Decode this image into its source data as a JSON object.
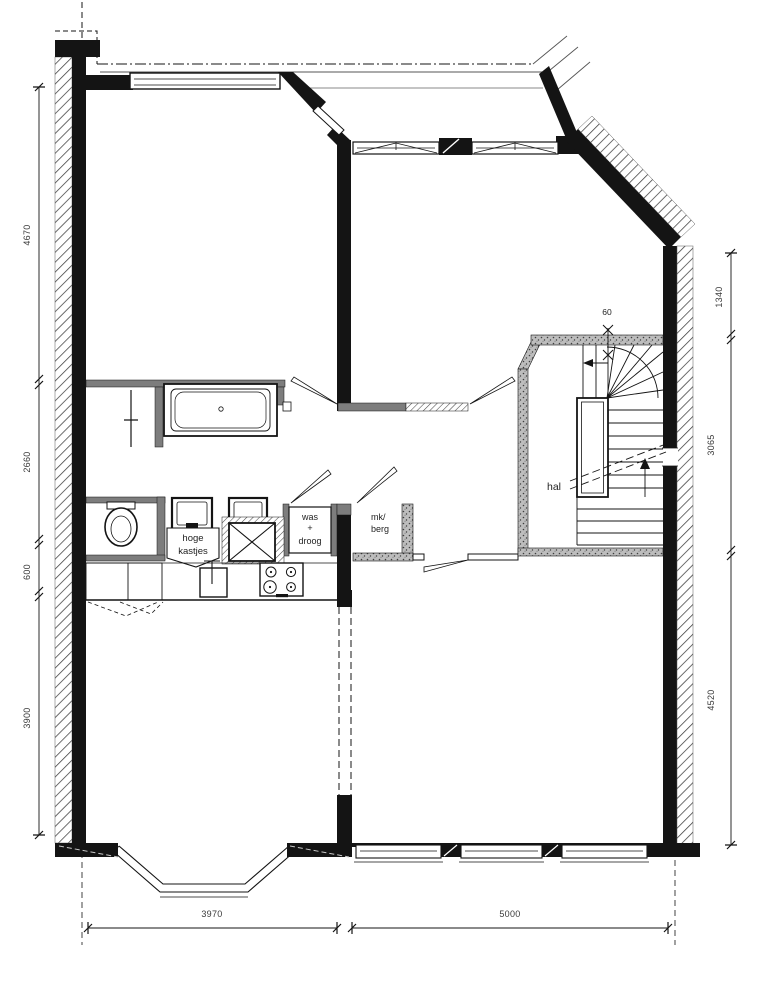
{
  "labels": {
    "hal": "hal",
    "was": [
      "was",
      "+",
      "droog"
    ],
    "kast": [
      "hoge",
      "kastjes"
    ],
    "mk": [
      "mk/",
      "berg"
    ],
    "stair_count": "60"
  },
  "dimensions": {
    "left": [
      "4670",
      "2660",
      "600",
      "3900"
    ],
    "right": [
      "1340",
      "3065",
      "4520"
    ],
    "bottom": [
      "3970",
      "5000"
    ]
  },
  "colors": {
    "wall": "#141414",
    "partition": "#7d7d7d",
    "dim_text": "#3a3a3a",
    "background": "#ffffff"
  }
}
